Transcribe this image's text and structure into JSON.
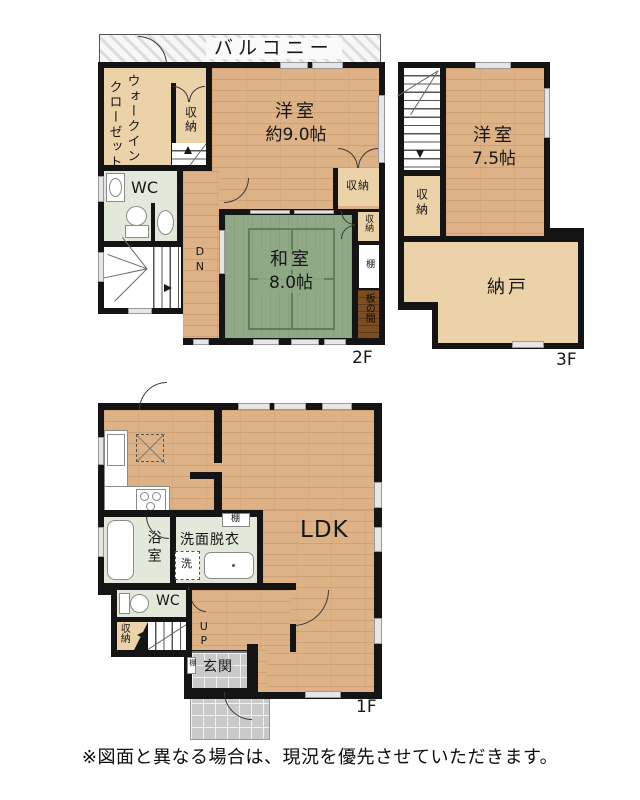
{
  "f2": {
    "floor_label": "2F",
    "balcony": "バルコニー",
    "wic_line1": "ウォークイン",
    "wic_line2": "クローゼット",
    "closet": "収納",
    "up": "UP",
    "dn": "DN",
    "room_west_name": "洋室",
    "room_west_size": "約9.0帖",
    "wc": "WC",
    "washitsu_name": "和室",
    "washitsu_size": "8.0帖",
    "shelf": "棚",
    "itanoma": "板の間"
  },
  "f3": {
    "floor_label": "3F",
    "dn": "DN",
    "room_name": "洋室",
    "room_size": "7.5帖",
    "closet": "収納",
    "nando": "納戸"
  },
  "f1": {
    "floor_label": "1F",
    "ldk": "LDK",
    "bath": "浴室",
    "washroom": "洗面脱衣",
    "laundry": "洗",
    "shelf": "棚",
    "wc": "WC",
    "closet": "収納",
    "up": "UP",
    "genkan": "玄関"
  },
  "note": {
    "disclaimer": "※図面と異なる場合は、現況を優先させていただきます。"
  },
  "colors": {
    "wall": "#141414",
    "wood_floor": "#dcb286",
    "closet_tan": "#ecd2a8",
    "tatami_green": "#8fa886",
    "service_green": "#e2e8da",
    "tile_gray": "#c9c9c9",
    "itanoma_brown": "#7c4e22"
  }
}
